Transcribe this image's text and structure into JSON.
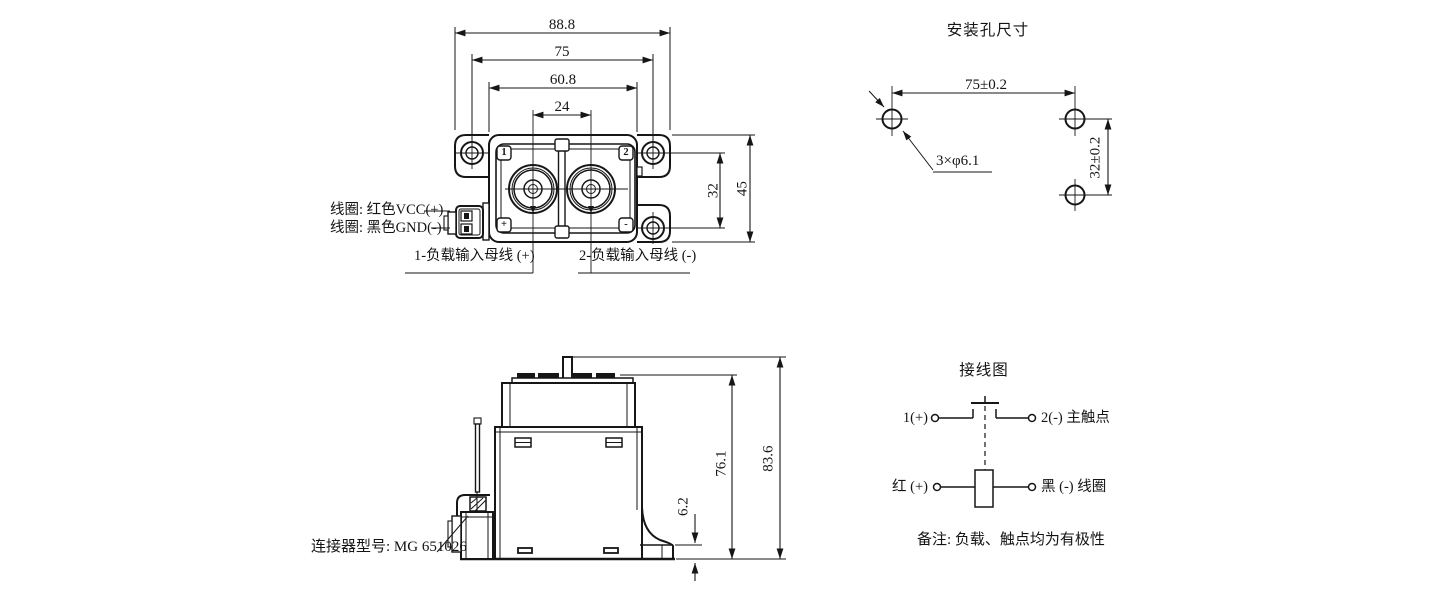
{
  "views": {
    "top": {
      "dims": {
        "overall_width": "88.8",
        "mount_span": "75",
        "body_width": "60.8",
        "terminal_pitch": "24",
        "mount_vspan": "32",
        "body_height": "45"
      },
      "labels": {
        "coil_red": "线圈: 红色VCC(+)",
        "coil_black": "线圈: 黑色GND(-)",
        "busbar_pos": "1-负载输入母线 (+)",
        "busbar_neg": "2-负载输入母线 (-)",
        "marker_1": "1",
        "marker_2": "2",
        "marker_plus": "+",
        "marker_minus": "-"
      }
    },
    "mounting": {
      "title": "安装孔尺寸",
      "dims": {
        "hole_span_h": "75±0.2",
        "hole_span_v": "32±0.2",
        "hole_callout": "3×φ6.1"
      }
    },
    "side": {
      "dims": {
        "body_height": "76.1",
        "overall_height": "83.6",
        "foot_height": "6.2"
      },
      "labels": {
        "connector_model": "连接器型号: MG 651026"
      }
    },
    "wiring": {
      "title": "接线图",
      "labels": {
        "contact_pos": "1(+)",
        "contact_neg": "2(-) 主触点",
        "coil_pos": "红 (+)",
        "coil_neg": "黑 (-) 线圈",
        "note": "备注: 负载、触点均为有极性"
      }
    }
  },
  "line_color": "#161616"
}
